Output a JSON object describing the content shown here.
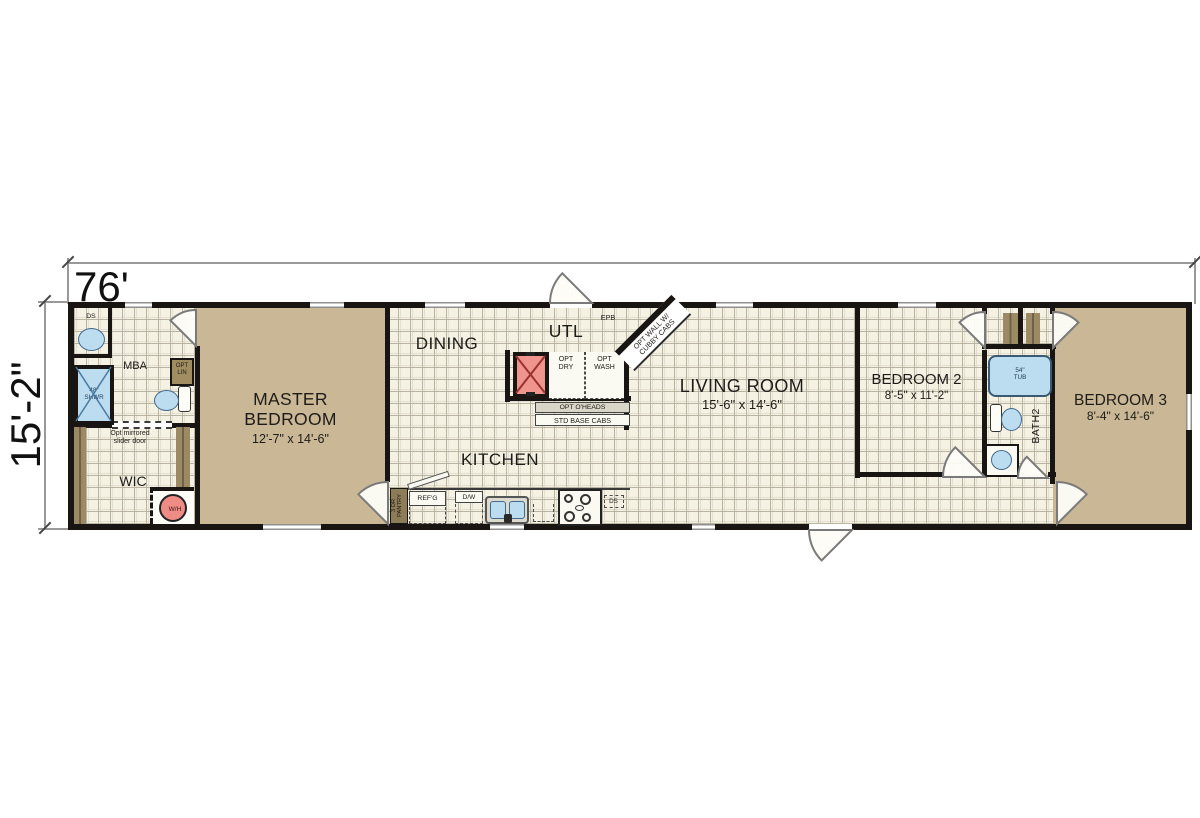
{
  "dimensions": {
    "width_label": "76'",
    "height_label": "15'-2\""
  },
  "rooms": {
    "master_bedroom": {
      "name": "MASTER\nBEDROOM",
      "size": "12'-7\" x 14'-6\""
    },
    "dining": {
      "name": "DINING"
    },
    "utility": {
      "name": "UTL"
    },
    "kitchen": {
      "name": "KITCHEN"
    },
    "living_room": {
      "name": "LIVING ROOM",
      "size": "15'-6\" x 14'-6\""
    },
    "bedroom_2": {
      "name": "BEDROOM 2",
      "size": "8'-5\" x 11'-2\""
    },
    "bedroom_3": {
      "name": "BEDROOM 3",
      "size": "8'-4\" x 14'-6\""
    },
    "master_bath": {
      "name": "MBA"
    },
    "walk_in_closet": {
      "name": "WIC"
    },
    "bath_2": {
      "name": "BATH2"
    }
  },
  "fixtures": {
    "drop_soffit_mba": "DS",
    "shower": "48\"\nSHWR",
    "opt_linen": "OPT\nLIN",
    "slider_note": "Opt mirrored\nslider door",
    "water_heater": "W/H",
    "elec_panel": "EPB",
    "opt_dryer": "OPT\nDRY",
    "opt_washer": "OPT\nWASH",
    "opt_wall_note": "OPT WALL W/\nCUBBY CABS",
    "opt_overheads": "OPT O'HEADS",
    "std_base_cabs": "STD BASE CABS",
    "pantry": "3 DR\nPANTRY",
    "fridge": "REF'G",
    "dishwasher": "D/W",
    "drop_soffit_kitchen": "DS",
    "tub": "54\"\nTUB"
  },
  "colors": {
    "wall": "#181512",
    "carpet": "#c9b795",
    "tile": "#f5f2e4",
    "fixture_blue": "#bcdcf0",
    "furnace_red": "#ef958d",
    "cabinet_brown": "#9b8a64",
    "window_gray": "#8f8f8f"
  }
}
